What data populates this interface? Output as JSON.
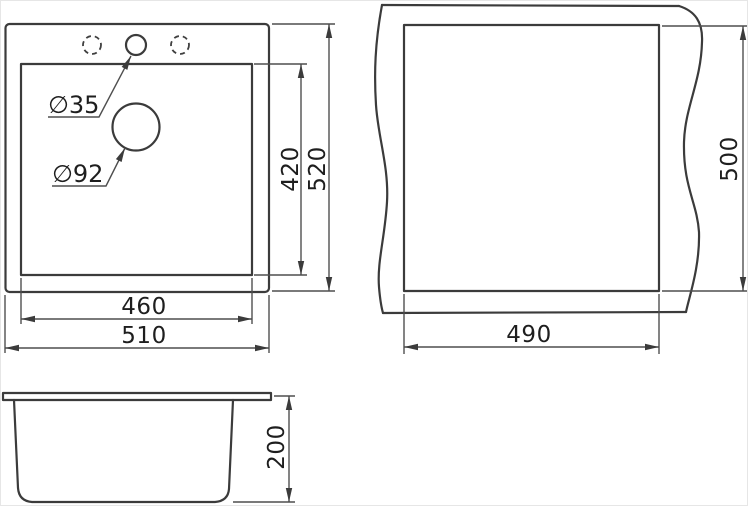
{
  "page": {
    "background_color": "#ffffff",
    "object_line_color": "#3b3b3b",
    "dimension_line_color": "#4f4f4f",
    "text_color": "#1e1e1e"
  },
  "sink_top_view": {
    "faucet_hole_diameter_label": "∅35",
    "drain_hole_diameter_label": "∅92",
    "inner_width_mm": "460",
    "outer_width_mm": "510",
    "inner_depth_mm": "420",
    "outer_depth_mm": "520"
  },
  "countertop_cutout_view": {
    "cutout_width_mm": "490",
    "cutout_depth_mm": "500"
  },
  "side_view": {
    "bowl_depth_mm": "200"
  }
}
